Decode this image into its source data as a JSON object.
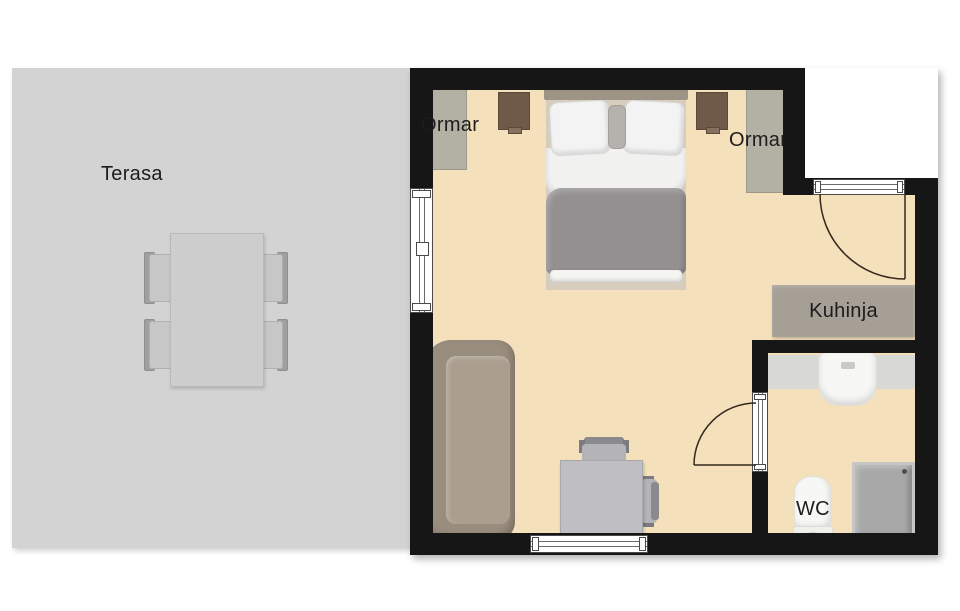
{
  "terrace": {
    "label": "Terasa"
  },
  "bedroom": {
    "wardrobe_left_label": "Ormar",
    "wardrobe_right_label": "Ormar"
  },
  "kitchen": {
    "label": "Kuhinja"
  },
  "bathroom": {
    "wc_label": "WC"
  },
  "furniture_visible": [
    "double-bed",
    "nightstand-left",
    "nightstand-right",
    "wardrobe-left",
    "wardrobe-right",
    "sofa",
    "desk",
    "desk-chair-top",
    "desk-chair-right",
    "kitchen-counter",
    "bathroom-vanity",
    "sink",
    "toilet",
    "shower",
    "terrace-table",
    "terrace-chairs-x4"
  ],
  "openings_visible": [
    "window-left-wall",
    "window-bottom-wall",
    "entrance-door-top-right",
    "bathroom-door"
  ],
  "colors": {
    "wall": "#161616",
    "floor": "#f4e0ba",
    "terrace": "#d3d3d3",
    "text": "#1c1c1c",
    "wardrobe": "#b3b1a3",
    "nightstand": "#6f5a4a",
    "headboard": "#9e9486",
    "bed_frame": "#d6cdbf",
    "pillow": "#f3f3f3",
    "duvet": "#949091",
    "sofa": "#998d7e",
    "sofa_cushion": "#aa9e8e",
    "desk": "#bfbfc3",
    "chair": "#b4b4b8",
    "chair_back": "#8a8a8e",
    "kitchen_counter": "#a59f96",
    "vanity": "#d8d8d4",
    "fixture": "#f7f7f5",
    "shower": "#a8a8a8",
    "table": "#cdcdcd",
    "terrace_chair": "#c7c7c7",
    "terrace_chair_back": "#a0a0a0",
    "door_arc": "#33281c",
    "window_frame": "#4a4a4a"
  }
}
